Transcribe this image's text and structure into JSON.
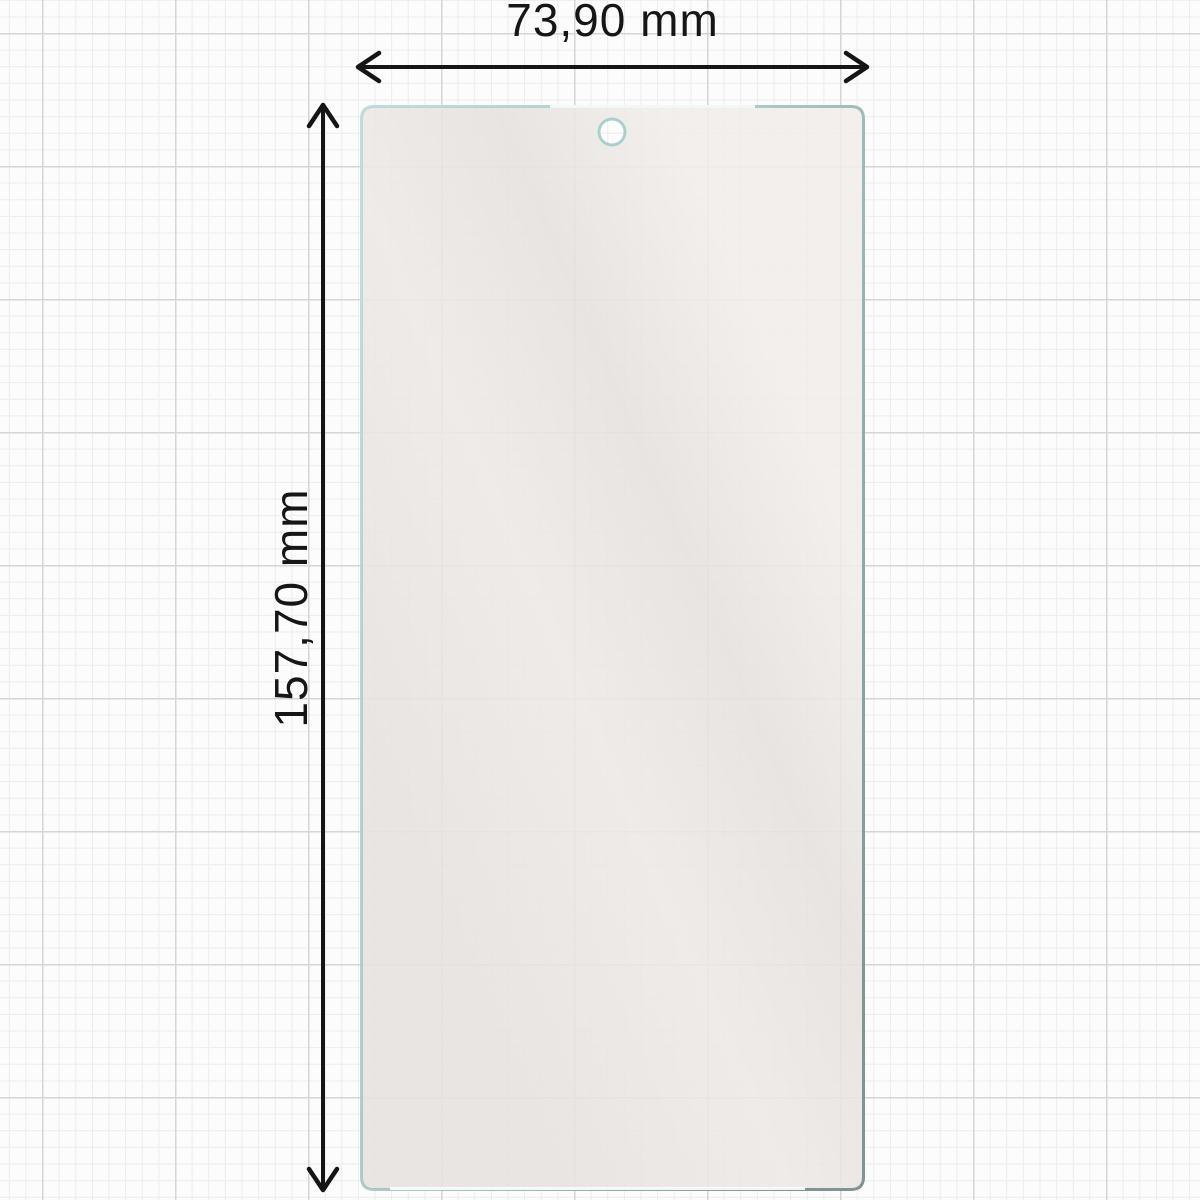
{
  "diagram": {
    "width_label": "73,90 mm",
    "height_label": "157,70 mm",
    "colors": {
      "background": "#fcfcfc",
      "grid_minor": "#ececec",
      "grid_major": "#d5d5d5",
      "glass_fill": "#f0edea",
      "glass_edge_light": "#bcdedc",
      "glass_edge_dark": "#7d9492",
      "dimension_line": "#151515"
    }
  }
}
